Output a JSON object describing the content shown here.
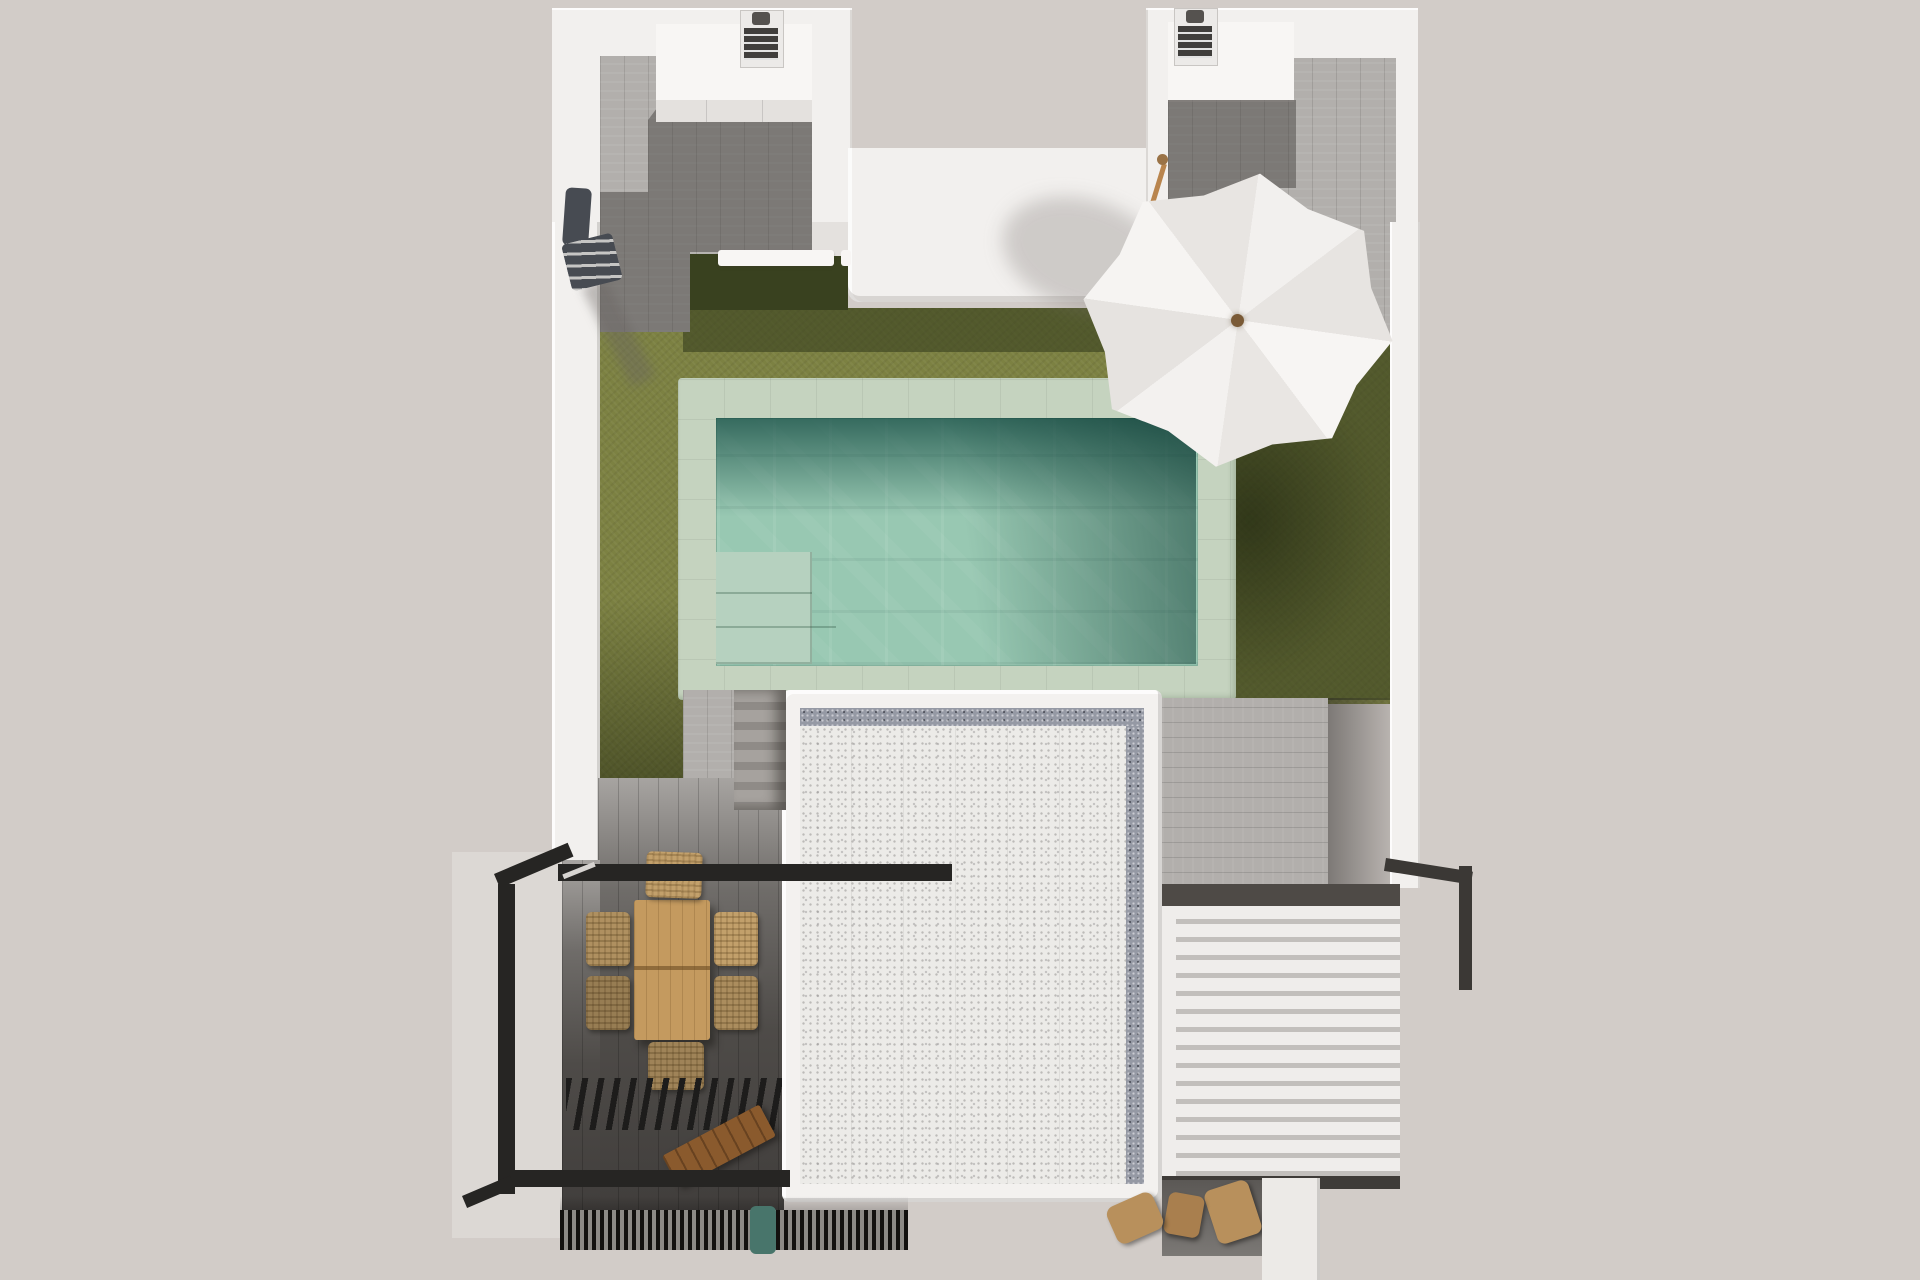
{
  "meta": {
    "title": "Top-down 3D architectural render of a villa plot with pool and roof terrace",
    "canvas": {
      "width": 1920,
      "height": 1280
    },
    "view": "bird's-eye / plan view, photorealistic render, no text or UI widgets visible"
  },
  "colors": {
    "bg": "#d2ccc8",
    "wall": "#f2f0ee",
    "wallBright": "#f8f6f4",
    "wallShade": "#e4e1de",
    "deck": "#b2afac",
    "deckDark": "#4e4b48",
    "grass": "#7c8142",
    "grassShadow": "#39411f",
    "coping": "#c5d3bf",
    "water": "#98c8b2",
    "waterShadow": "#2f6a60",
    "poolSteps": "#b6d1bf",
    "roof": "#ecebe8",
    "roofEdge": "#f3f1ef",
    "roofBorder": "#9599a4",
    "louver": "#efedeb",
    "louverGap": "#c2bfbc",
    "beam": "#4e4a46",
    "frame": "#262523",
    "table": "#c49a5f",
    "bench": "#8a5a2d",
    "chair": "#c2a06b",
    "stair": "#a6a29e",
    "shower": "#474b52",
    "appliance": "#403e3c",
    "umbrella": "#f3f1ef",
    "umbrellaShade": "#e8e5e2",
    "pole": "#b9854e",
    "teal": "#48756b",
    "walkway": "#eceae7",
    "floorDark": "#7b7875",
    "stool": "#b8905c"
  },
  "scene": {
    "description": "White-walled plot seen from above: two service wings at top with wood decking and utility units, central lawn with rectangular pool (green stone coping, corner steps), white parasol over the lawn, gray stone stair down to a lower terrace, large white gravel roof of the house below, white louvered pergola on the right, black steel pergola frame over a timber dining set on dark decking at bottom left, slatted grill canopy, bench, bottom grate and small wooden stools.",
    "labels": {
      "lawn": "artificial lawn",
      "pool": "swimming pool",
      "poolSteps": "pool corner steps",
      "umbrella": "white parasol",
      "leftWing": "left service wing with decking",
      "rightWing": "right service wing with decking",
      "centralVolume": "central white roof volume",
      "stairs": "stone stair to lower terrace",
      "roof": "house roof with gravel field",
      "sidePath": "timber side path",
      "louverPergola": "white louvered pergola",
      "diningSet": "timber dining table and wicker chairs",
      "pergolaFrame": "black steel pergola frame",
      "slatCanopy": "black slatted canopy",
      "bench": "wooden bench",
      "grate": "ventilation grate",
      "shower": "wall-mounted outdoor shower",
      "applianceLeft": "utility unit",
      "applianceRight": "utility unit",
      "walkway": "white walkway",
      "stools": "wooden stools"
    }
  }
}
